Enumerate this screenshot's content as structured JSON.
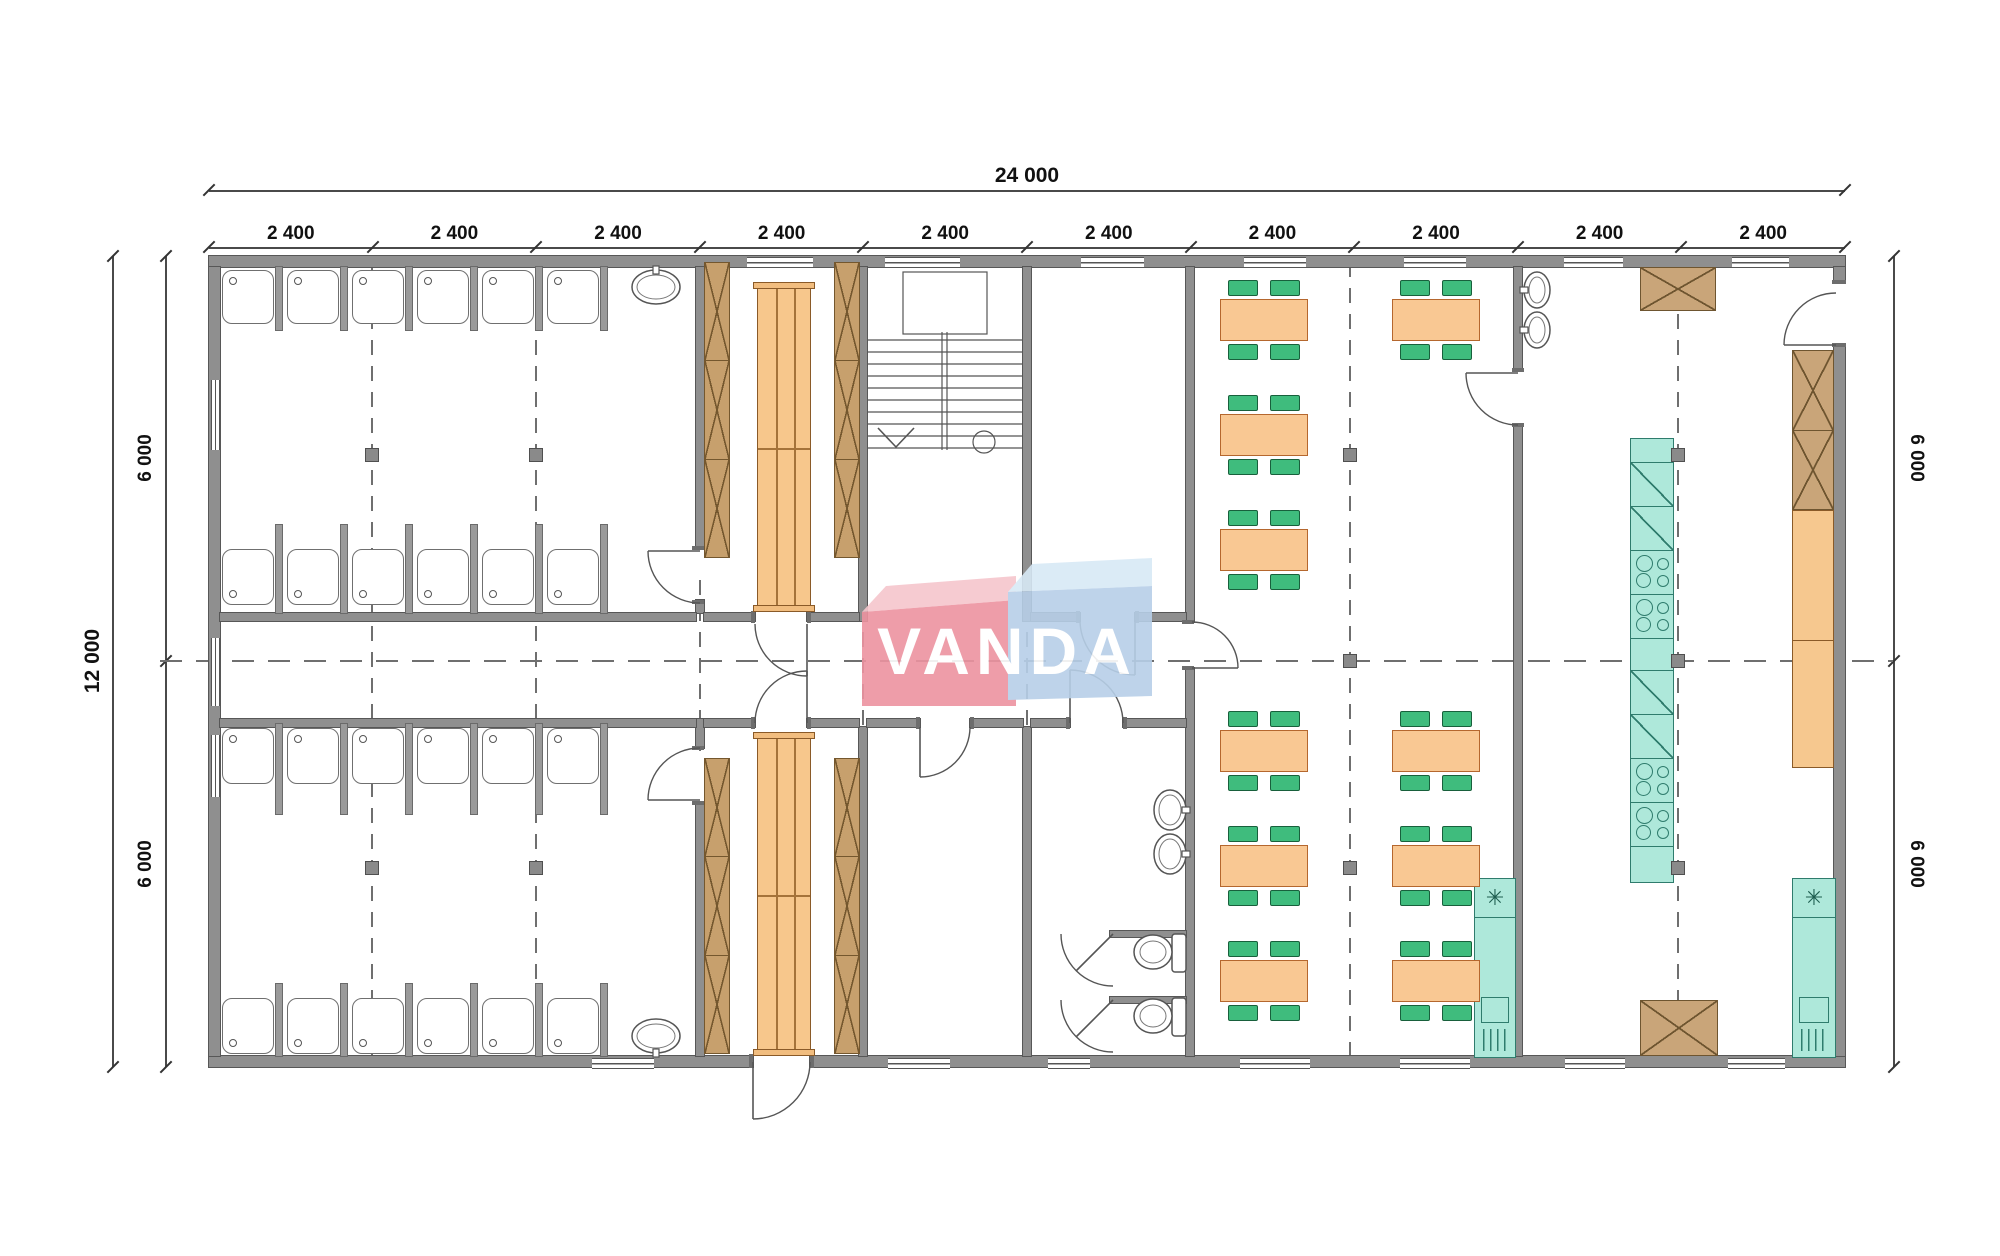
{
  "logo": {
    "text": "VANDA",
    "red_face": "#ed93a0",
    "red_top": "#f6c6cd",
    "blue_face": "#b7cfe8",
    "blue_top": "#d8e9f6"
  },
  "dims": {
    "total_top": "24 000",
    "bays": [
      "2 400",
      "2 400",
      "2 400",
      "2 400",
      "2 400",
      "2 400",
      "2 400",
      "2 400",
      "2 400",
      "2 400"
    ],
    "left_total": "12 000",
    "left_halves": [
      "6 000",
      "6 000"
    ],
    "right_halves": [
      "6 000",
      "6 000"
    ]
  },
  "plan": {
    "origin_x": 209,
    "bay_px": 163.6,
    "top_y": 256,
    "bottom_y": 1067,
    "walls": [
      [
        209,
        256,
        1636,
        11
      ],
      [
        209,
        1056,
        544,
        11
      ],
      [
        810,
        1056,
        1035,
        11
      ],
      [
        209,
        267,
        11,
        789
      ],
      [
        1834,
        267,
        11,
        15
      ],
      [
        1834,
        345,
        11,
        711
      ],
      [
        696,
        267,
        8,
        281
      ],
      [
        696,
        600,
        8,
        13
      ],
      [
        696,
        719,
        8,
        29
      ],
      [
        696,
        803,
        8,
        253
      ],
      [
        859,
        267,
        8,
        354
      ],
      [
        859,
        727,
        8,
        329
      ],
      [
        1023,
        267,
        8,
        354
      ],
      [
        1023,
        727,
        8,
        329
      ],
      [
        1186,
        267,
        8,
        355
      ],
      [
        1186,
        668,
        8,
        388
      ],
      [
        1514,
        267,
        8,
        103
      ],
      [
        1514,
        425,
        8,
        631
      ],
      [
        220,
        613,
        476,
        8
      ],
      [
        704,
        613,
        51,
        8
      ],
      [
        807,
        613,
        52,
        8
      ],
      [
        1031,
        613,
        49,
        8
      ],
      [
        1135,
        613,
        51,
        8
      ],
      [
        220,
        719,
        476,
        8
      ],
      [
        704,
        719,
        51,
        8
      ],
      [
        807,
        719,
        52,
        8
      ],
      [
        867,
        719,
        53,
        8
      ],
      [
        970,
        719,
        53,
        8
      ],
      [
        1031,
        719,
        39,
        8
      ],
      [
        1123,
        719,
        63,
        8
      ],
      [
        1110,
        931,
        76,
        6
      ],
      [
        1110,
        997,
        76,
        6
      ]
    ],
    "jambs": [
      [
        751,
        611,
        4,
        12
      ],
      [
        807,
        611,
        4,
        12
      ],
      [
        751,
        717,
        4,
        12
      ],
      [
        807,
        717,
        4,
        12
      ],
      [
        692,
        546,
        12,
        4
      ],
      [
        692,
        600,
        12,
        4
      ],
      [
        692,
        746,
        12,
        4
      ],
      [
        692,
        801,
        12,
        4
      ],
      [
        1076,
        611,
        4,
        12
      ],
      [
        1135,
        611,
        4,
        12
      ],
      [
        1182,
        620,
        12,
        4
      ],
      [
        1182,
        666,
        12,
        4
      ],
      [
        1066,
        717,
        4,
        12
      ],
      [
        1123,
        717,
        4,
        12
      ],
      [
        916,
        717,
        4,
        12
      ],
      [
        970,
        717,
        4,
        12
      ],
      [
        1832,
        280,
        14,
        4
      ],
      [
        1832,
        343,
        14,
        4
      ],
      [
        1512,
        368,
        12,
        4
      ],
      [
        1512,
        423,
        12,
        4
      ],
      [
        749,
        1054,
        4,
        14
      ],
      [
        810,
        1054,
        4,
        14
      ]
    ],
    "windows_h": [
      [
        747,
        257,
        66
      ],
      [
        885,
        257,
        75
      ],
      [
        1081,
        257,
        63
      ],
      [
        1244,
        257,
        62
      ],
      [
        1404,
        257,
        62
      ],
      [
        1564,
        257,
        59
      ],
      [
        1732,
        257,
        57
      ],
      [
        592,
        1058,
        62
      ],
      [
        888,
        1058,
        62
      ],
      [
        1048,
        1058,
        42
      ],
      [
        1240,
        1058,
        70
      ],
      [
        1400,
        1058,
        70
      ],
      [
        1565,
        1058,
        60
      ],
      [
        1728,
        1058,
        57
      ]
    ],
    "windows_v": [
      [
        211,
        380,
        70
      ],
      [
        211,
        638,
        68
      ],
      [
        211,
        735,
        62
      ]
    ],
    "dividers": [
      [
        276,
        267,
        6,
        63
      ],
      [
        341,
        267,
        6,
        63
      ],
      [
        406,
        267,
        6,
        63
      ],
      [
        471,
        267,
        6,
        63
      ],
      [
        536,
        267,
        6,
        63
      ],
      [
        601,
        267,
        6,
        63
      ],
      [
        276,
        525,
        6,
        88
      ],
      [
        341,
        525,
        6,
        88
      ],
      [
        406,
        525,
        6,
        88
      ],
      [
        471,
        525,
        6,
        88
      ],
      [
        536,
        525,
        6,
        88
      ],
      [
        601,
        525,
        6,
        88
      ],
      [
        276,
        724,
        6,
        90
      ],
      [
        341,
        724,
        6,
        90
      ],
      [
        406,
        724,
        6,
        90
      ],
      [
        471,
        724,
        6,
        90
      ],
      [
        536,
        724,
        6,
        90
      ],
      [
        601,
        724,
        6,
        90
      ],
      [
        276,
        984,
        6,
        72
      ],
      [
        341,
        984,
        6,
        72
      ],
      [
        406,
        984,
        6,
        72
      ],
      [
        471,
        984,
        6,
        72
      ],
      [
        536,
        984,
        6,
        72
      ],
      [
        601,
        984,
        6,
        72
      ]
    ],
    "showers": [
      [
        222,
        270,
        52,
        54,
        "tl"
      ],
      [
        287,
        270,
        52,
        54,
        "tl"
      ],
      [
        352,
        270,
        52,
        54,
        "tl"
      ],
      [
        417,
        270,
        52,
        54,
        "tl"
      ],
      [
        482,
        270,
        52,
        54,
        "tl"
      ],
      [
        547,
        270,
        52,
        54,
        "tl"
      ],
      [
        222,
        549,
        52,
        56,
        "bl"
      ],
      [
        287,
        549,
        52,
        56,
        "bl"
      ],
      [
        352,
        549,
        52,
        56,
        "bl"
      ],
      [
        417,
        549,
        52,
        56,
        "bl"
      ],
      [
        482,
        549,
        52,
        56,
        "bl"
      ],
      [
        547,
        549,
        52,
        56,
        "bl"
      ],
      [
        222,
        728,
        52,
        56,
        "tl"
      ],
      [
        287,
        728,
        52,
        56,
        "tl"
      ],
      [
        352,
        728,
        52,
        56,
        "tl"
      ],
      [
        417,
        728,
        52,
        56,
        "tl"
      ],
      [
        482,
        728,
        52,
        56,
        "tl"
      ],
      [
        547,
        728,
        52,
        56,
        "tl"
      ],
      [
        222,
        998,
        52,
        56,
        "bl"
      ],
      [
        287,
        998,
        52,
        56,
        "bl"
      ],
      [
        352,
        998,
        52,
        56,
        "bl"
      ],
      [
        417,
        998,
        52,
        56,
        "bl"
      ],
      [
        482,
        998,
        52,
        56,
        "bl"
      ],
      [
        547,
        998,
        52,
        56,
        "bl"
      ]
    ],
    "sinks": [
      [
        632,
        270,
        48,
        34,
        "up"
      ],
      [
        632,
        1019,
        48,
        34,
        "down"
      ],
      [
        1524,
        272,
        26,
        36,
        "left"
      ],
      [
        1524,
        312,
        26,
        36,
        "left"
      ],
      [
        1154,
        790,
        32,
        40,
        "right"
      ],
      [
        1154,
        834,
        32,
        40,
        "right"
      ]
    ],
    "toilets": [
      [
        1136,
        950
      ],
      [
        1136,
        1014
      ]
    ],
    "benches_x": [
      [
        704,
        262,
        26,
        296
      ],
      [
        834,
        262,
        26,
        296
      ],
      [
        704,
        758,
        26,
        296
      ],
      [
        834,
        758,
        26,
        296
      ]
    ],
    "benches_c": [
      [
        757,
        288,
        54,
        318
      ],
      [
        757,
        738,
        54,
        312
      ]
    ],
    "cabinets_x": [
      [
        1640,
        267,
        76,
        44,
        1
      ],
      [
        1792,
        350,
        42,
        160,
        2
      ],
      [
        1640,
        1000,
        78,
        56,
        1
      ]
    ],
    "counters": [
      [
        1792,
        510,
        42,
        258
      ]
    ],
    "appliance_col": {
      "x": 1630,
      "y": 438,
      "w": 44,
      "segs": [
        [
          "plain",
          24
        ],
        [
          "fridge",
          44
        ],
        [
          "fridge",
          44
        ],
        [
          "stove",
          44
        ],
        [
          "stove",
          44
        ],
        [
          "plain",
          32
        ],
        [
          "fridge",
          44
        ],
        [
          "fridge",
          44
        ],
        [
          "stove",
          44
        ],
        [
          "stove",
          44
        ],
        [
          "plain",
          37
        ]
      ]
    },
    "fridges": [
      [
        1474,
        878,
        42,
        180
      ],
      [
        1792,
        878,
        44,
        180
      ]
    ],
    "tables": [
      [
        1220,
        299
      ],
      [
        1220,
        414
      ],
      [
        1220,
        529
      ],
      [
        1220,
        730
      ],
      [
        1220,
        845
      ],
      [
        1220,
        960
      ],
      [
        1392,
        299
      ],
      [
        1392,
        730
      ],
      [
        1392,
        845
      ],
      [
        1392,
        960
      ]
    ],
    "axes_v": [
      [
        372,
        262,
        1062
      ],
      [
        536,
        262,
        1062
      ],
      [
        1350,
        262,
        1062
      ],
      [
        1678,
        262,
        1062
      ]
    ],
    "axes_v_short": [
      [
        700,
        580,
        760
      ],
      [
        863,
        580,
        760
      ],
      [
        1027,
        580,
        760
      ]
    ],
    "axis_h": [
      661,
      160,
      1893
    ],
    "markers": [
      [
        365,
        448
      ],
      [
        529,
        448
      ],
      [
        365,
        861
      ],
      [
        529,
        861
      ],
      [
        1343,
        448
      ],
      [
        1343,
        654
      ],
      [
        1343,
        861
      ],
      [
        1671,
        448
      ],
      [
        1671,
        654
      ],
      [
        1671,
        861
      ]
    ],
    "stairs": {
      "x1": 868,
      "x2": 1022,
      "ty1": 340,
      "ty2": 448,
      "n": 10,
      "rails": [
        942,
        947
      ],
      "rail_y": [
        332,
        450
      ],
      "box": [
        903,
        272,
        84,
        62
      ],
      "arrow": [
        [
          878,
          428
        ],
        [
          896,
          447
        ],
        [
          914,
          428
        ]
      ],
      "circle": [
        984,
        442,
        11
      ]
    },
    "doors": [
      {
        "s": [
          755,
          624
        ],
        "e": [
          807,
          676
        ],
        "r": 52,
        "w": 0,
        "leaf": [
          [
            807,
            624
          ],
          [
            807,
            676
          ]
        ]
      },
      {
        "s": [
          755,
          723
        ],
        "e": [
          807,
          671
        ],
        "r": 52,
        "w": 1,
        "leaf": [
          [
            807,
            723
          ],
          [
            807,
            671
          ]
        ]
      },
      {
        "s": [
          700,
          603
        ],
        "e": [
          648,
          551
        ],
        "r": 52,
        "w": 1,
        "leaf": [
          [
            700,
            551
          ],
          [
            648,
            551
          ]
        ]
      },
      {
        "s": [
          700,
          748
        ],
        "e": [
          648,
          800
        ],
        "r": 52,
        "w": 0,
        "leaf": [
          [
            700,
            800
          ],
          [
            648,
            800
          ]
        ]
      },
      {
        "s": [
          1080,
          620
        ],
        "e": [
          1135,
          675
        ],
        "r": 55,
        "w": 0,
        "leaf": [
          [
            1135,
            620
          ],
          [
            1135,
            675
          ]
        ]
      },
      {
        "s": [
          1192,
          622
        ],
        "e": [
          1238,
          668
        ],
        "r": 46,
        "w": 1,
        "leaf": [
          [
            1192,
            668
          ],
          [
            1238,
            668
          ]
        ]
      },
      {
        "s": [
          1123,
          723
        ],
        "e": [
          1070,
          670
        ],
        "r": 53,
        "w": 0,
        "leaf": [
          [
            1070,
            723
          ],
          [
            1070,
            670
          ]
        ]
      },
      {
        "s": [
          970,
          727
        ],
        "e": [
          920,
          777
        ],
        "r": 50,
        "w": 1,
        "leaf": [
          [
            920,
            727
          ],
          [
            920,
            777
          ]
        ]
      },
      {
        "s": [
          1836,
          293
        ],
        "e": [
          1784,
          345
        ],
        "r": 52,
        "w": 0,
        "leaf": [
          [
            1836,
            345
          ],
          [
            1784,
            345
          ]
        ]
      },
      {
        "s": [
          1518,
          425
        ],
        "e": [
          1466,
          373
        ],
        "r": 52,
        "w": 1,
        "leaf": [
          [
            1518,
            373
          ],
          [
            1466,
            373
          ]
        ]
      },
      {
        "s": [
          810,
          1062
        ],
        "e": [
          753,
          1119
        ],
        "r": 57,
        "w": 1,
        "leaf": [
          [
            753,
            1062
          ],
          [
            753,
            1119
          ]
        ]
      },
      {
        "s": [
          1061,
          934
        ],
        "e": [
          1113,
          986
        ],
        "r": 52,
        "w": 0,
        "leaf": [
          [
            1113,
            934
          ],
          [
            1076,
            971
          ]
        ]
      },
      {
        "s": [
          1061,
          1000
        ],
        "e": [
          1113,
          1052
        ],
        "r": 52,
        "w": 0,
        "leaf": [
          [
            1113,
            1000
          ],
          [
            1076,
            1037
          ]
        ]
      }
    ]
  }
}
